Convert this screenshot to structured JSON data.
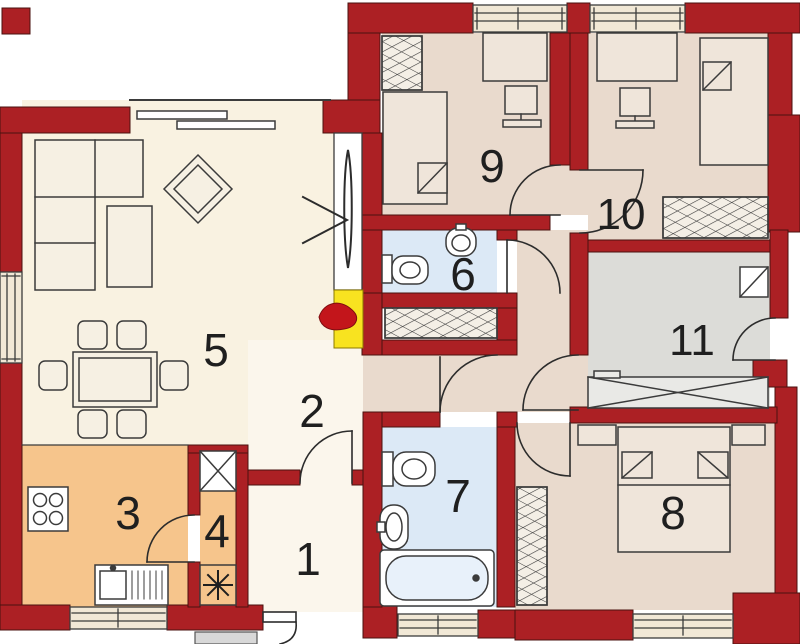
{
  "plan": {
    "rooms": [
      {
        "label": "1"
      },
      {
        "label": "2"
      },
      {
        "label": "3"
      },
      {
        "label": "4"
      },
      {
        "label": "5"
      },
      {
        "label": "6"
      },
      {
        "label": "7"
      },
      {
        "label": "8"
      },
      {
        "label": "9"
      },
      {
        "label": "10"
      },
      {
        "label": "11"
      }
    ],
    "colors": {
      "wall": "#ac2024",
      "wall_outline": "#4a120f",
      "living_floor": "#f9f2e1",
      "hall_floor": "#fbf6ec",
      "kitchen_floor": "#f6c58c",
      "bedroom_floor": "#e9dacd",
      "bathroom_floor": "#dce9f6",
      "closet_floor": "#dcdcd8",
      "window_fill": "#f1e8d6",
      "chimney_yellow": "#f8e320",
      "flame_red": "#c3151b",
      "furniture_outline": "#3b3b3b",
      "furniture_fill": "#f6f0e3"
    }
  }
}
